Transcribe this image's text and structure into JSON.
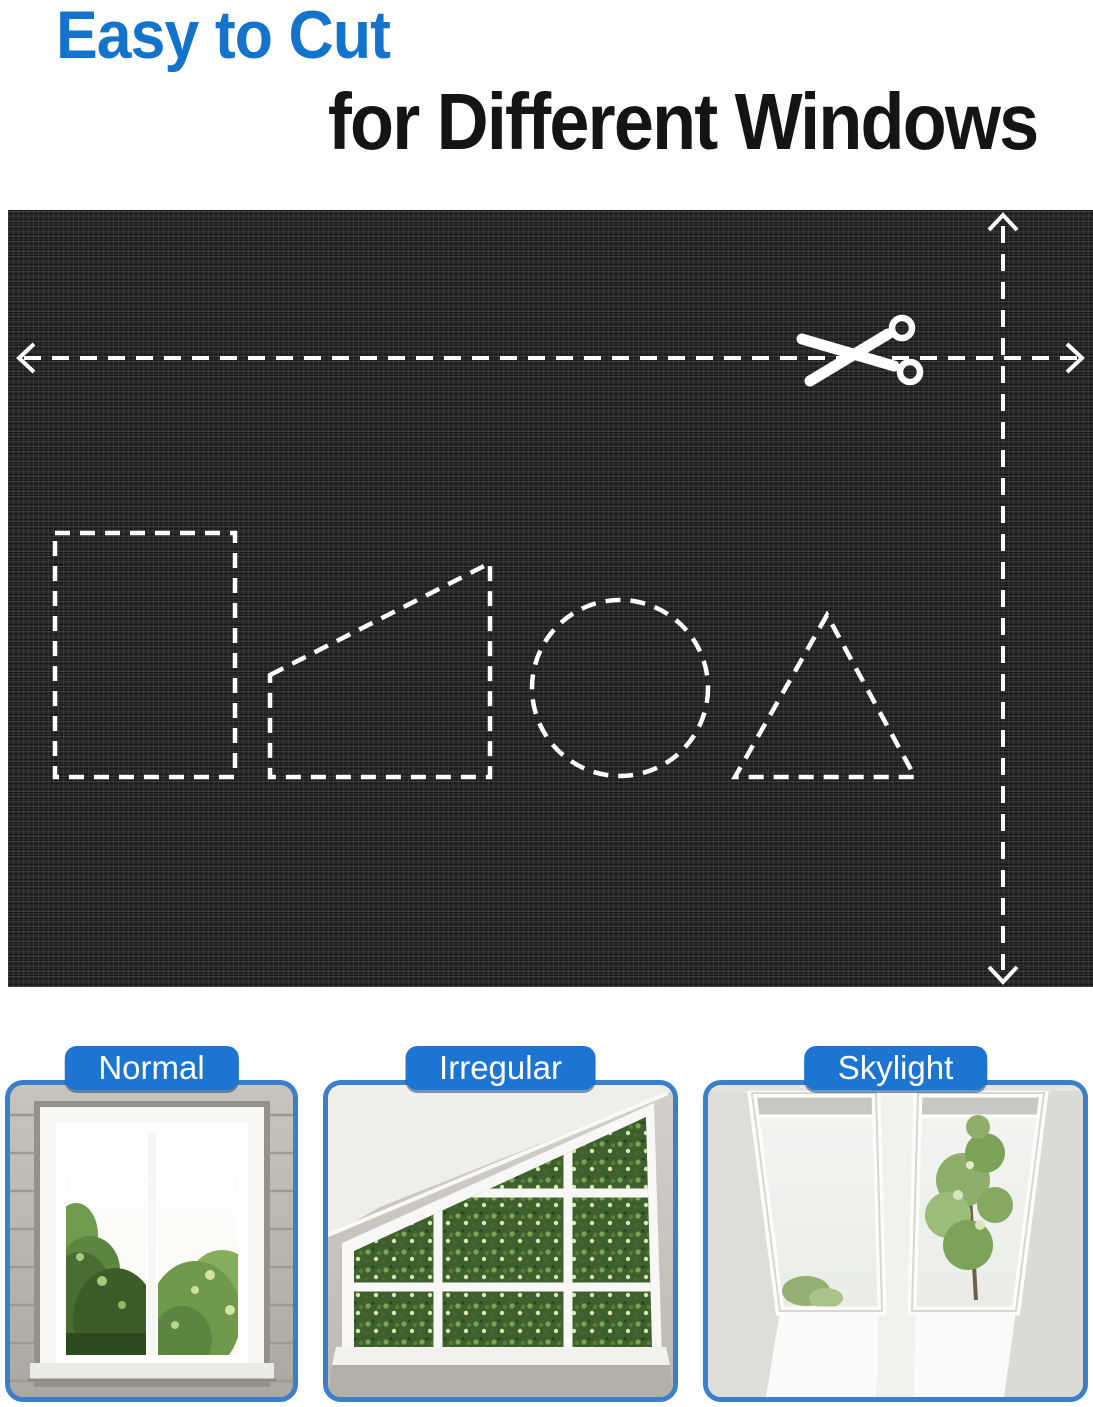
{
  "title": {
    "line1": "Easy to Cut",
    "line2": "for Different Windows"
  },
  "fabric_panel": {
    "description": "Black blackout fabric with white dashed cutting guides",
    "icon": "scissors-icon",
    "cut_shapes": [
      "rectangle",
      "right-trapezoid",
      "circle",
      "triangle"
    ],
    "guides": [
      "horizontal-width-arrow",
      "vertical-height-arrow"
    ]
  },
  "window_cards": [
    {
      "label": "Normal"
    },
    {
      "label": "Irregular"
    },
    {
      "label": "Skylight"
    }
  ],
  "colors": {
    "title_blue": "#1473cb",
    "badge_blue": "#1c76d1",
    "card_border_blue": "#3b7fc9",
    "fabric_black": "#262626",
    "guide_white": "#ffffff"
  }
}
